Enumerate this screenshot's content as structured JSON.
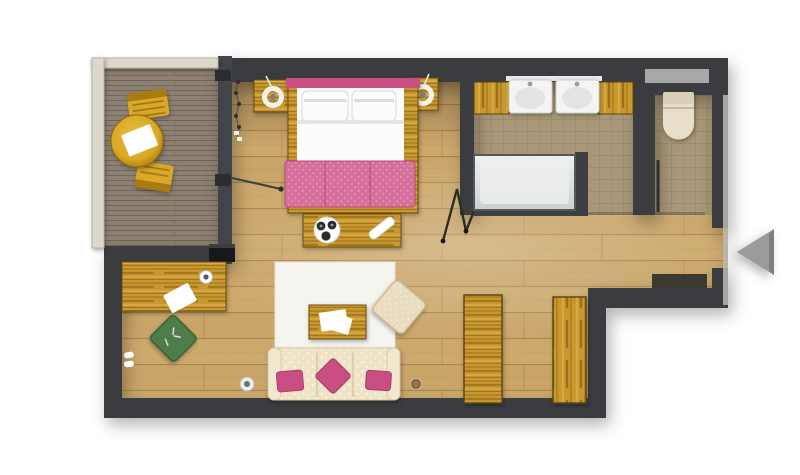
{
  "scene": {
    "type": "floor-plan",
    "view": "top-down-render",
    "rooms": [
      {
        "id": "terrace",
        "items": [
          "terrace-table",
          "terrace-chair-top",
          "terrace-chair-bottom",
          "terrace-railing",
          "terrace-decking"
        ]
      },
      {
        "id": "bedroom",
        "items": [
          "double-bed",
          "pillow",
          "bed-blanket",
          "nightstand-left",
          "nightstand-right",
          "lamp-left",
          "lamp-right",
          "bed-bench",
          "serving-tray",
          "hanging-decor",
          "valet-stand",
          "terrace-door"
        ]
      },
      {
        "id": "bathroom",
        "items": [
          "sink-left",
          "sink-right",
          "vanity-counter-left",
          "vanity-counter-right",
          "towel-bar",
          "bathtub"
        ]
      },
      {
        "id": "wc",
        "items": [
          "toilet",
          "wc-window",
          "wc-door"
        ]
      },
      {
        "id": "entry",
        "items": [
          "doormat",
          "entrance-opening",
          "entrance-arrow"
        ]
      },
      {
        "id": "living-area",
        "items": [
          "desk",
          "desk-paper",
          "coaster",
          "wall-tv",
          "green-cushion",
          "slippers",
          "floor-plate",
          "area-rug",
          "coffee-table",
          "magazines",
          "pouf",
          "sofa",
          "sofa-pillow-left",
          "sofa-pillow-center",
          "sofa-pillow-right",
          "cabinet-left",
          "cabinet-right",
          "floor-knob"
        ]
      }
    ]
  },
  "colors": {
    "wall": "#3a3c3f",
    "wall_dark": "#2b2d2f",
    "glass_wall": "#414448",
    "railing": "#ddd8cc",
    "railing_edge": "#b8b2a3",
    "floor_wood": "#c9a569",
    "floor_wood_line": "#8f6c38",
    "floor_wood_light": "#e0c184",
    "deck": "#8d8173",
    "deck_line": "#675d51",
    "tile": "#a99877",
    "tile_line": "#857659",
    "rug": "#f6f4ee",
    "pink": "#c94f82",
    "pink_light": "#d76f9c",
    "pink_dark": "#a83c67",
    "white_fabric": "#fcfcfc",
    "gold_wood": "#c8992f",
    "gold_wood_dark": "#7c5a14",
    "amber": "#d8a826",
    "sofa": "#eee3c6",
    "sofa_dot": "#fbf6e6",
    "green": "#4e7d4a",
    "green_dark": "#3a6238",
    "cream": "#e9dcc0",
    "arrow": "#9b9b99",
    "tub": "#dfe2df",
    "tub_frame": "#3c4043",
    "fixture_white": "#f4f5f2",
    "fixture_shade": "#e2e5e1",
    "toilet_cream": "#e7dfc8",
    "window_gray": "#a8a9a7",
    "mat": "#3a3a31",
    "black": "#17181a",
    "paper": "#ffffff"
  }
}
